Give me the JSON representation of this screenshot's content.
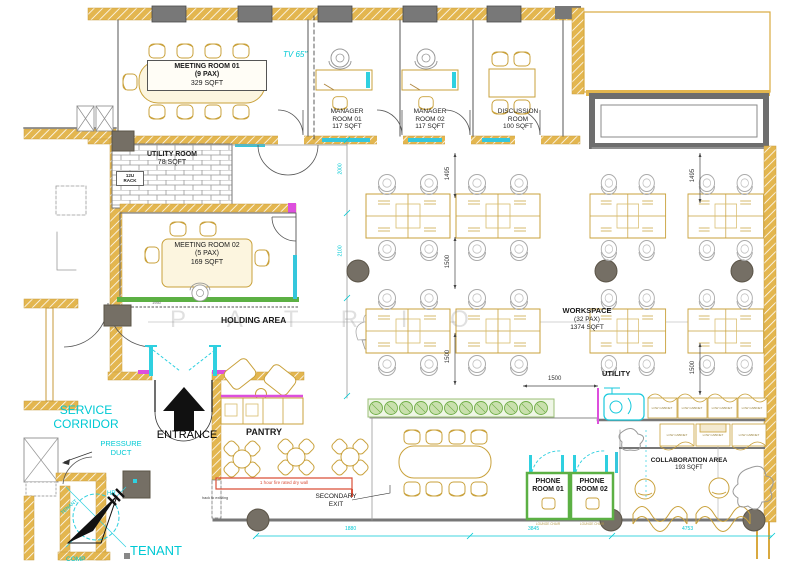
{
  "rooms": {
    "m1": {
      "name": "MEETING ROOM 01",
      "pax": "(9 PAX)",
      "area": "329 SQFT"
    },
    "mgr1": {
      "l1": "MANAGER",
      "l2": "ROOM 01",
      "area": "117 SQFT"
    },
    "mgr2": {
      "l1": "MANAGER",
      "l2": "ROOM 02",
      "area": "117 SQFT"
    },
    "disc": {
      "l1": "DISCUSSION",
      "l2": "ROOM",
      "area": "100 SQFT"
    },
    "util_room": {
      "name": "UTILITY ROOM",
      "area": "78 SQFT"
    },
    "m2": {
      "name": "MEETING ROOM 02",
      "pax": "(5 PAX)",
      "area": "169 SQFT"
    },
    "holding": {
      "name": "HOLDING AREA"
    },
    "ws": {
      "name": "WORKSPACE",
      "pax": "(32 PAX)",
      "area": "1374 SQFT"
    },
    "pantry": {
      "name": "PANTRY"
    },
    "utility": {
      "name": "UTILITY"
    },
    "ph1": {
      "l1": "PHONE",
      "l2": "ROOM 01"
    },
    "ph2": {
      "l1": "PHONE",
      "l2": "ROOM 02"
    },
    "collab": {
      "name": "COLLABORATION AREA",
      "area": "193 SQFT"
    }
  },
  "ann": {
    "tv": "TV 65\"",
    "rack1": "12U",
    "rack2": "RACK",
    "entrance": "ENTRANCE",
    "svc1": "SERVICE",
    "svc2": "CORRIDOR",
    "duct1": "PRESSURE",
    "duct2": "DUCT",
    "hr": "HR",
    "tenant_sm": "TENANT",
    "comp": "COMP",
    "tenant": "TENANT",
    "sec1": "SECONDARY",
    "sec2": "EXIT",
    "fire": "1 hour fire rated dry wall",
    "hack": "hack to existing",
    "cab": "LOW CABINET",
    "lounge": "LOUNGE CHAIR",
    "wm": "P A T R I O"
  },
  "dims": {
    "a1495": "1495",
    "b1500": "1500",
    "c1500": "1500",
    "d1495": "1495",
    "e1500": "1500",
    "h1500": "1500",
    "c2000": "2000",
    "c2100": "2100",
    "x1880": "1880",
    "x3845": "3845",
    "x4753": "4753",
    "g1950": "1950"
  },
  "colors": {
    "wall_gold": "#E3B64F",
    "furniture": "#C9A13B",
    "cyan": "#00C9D4",
    "teal": "#35C7DC",
    "green": "#5CB044",
    "magenta": "#DD4FDD",
    "red": "#D94F38",
    "gray": "#787878"
  }
}
